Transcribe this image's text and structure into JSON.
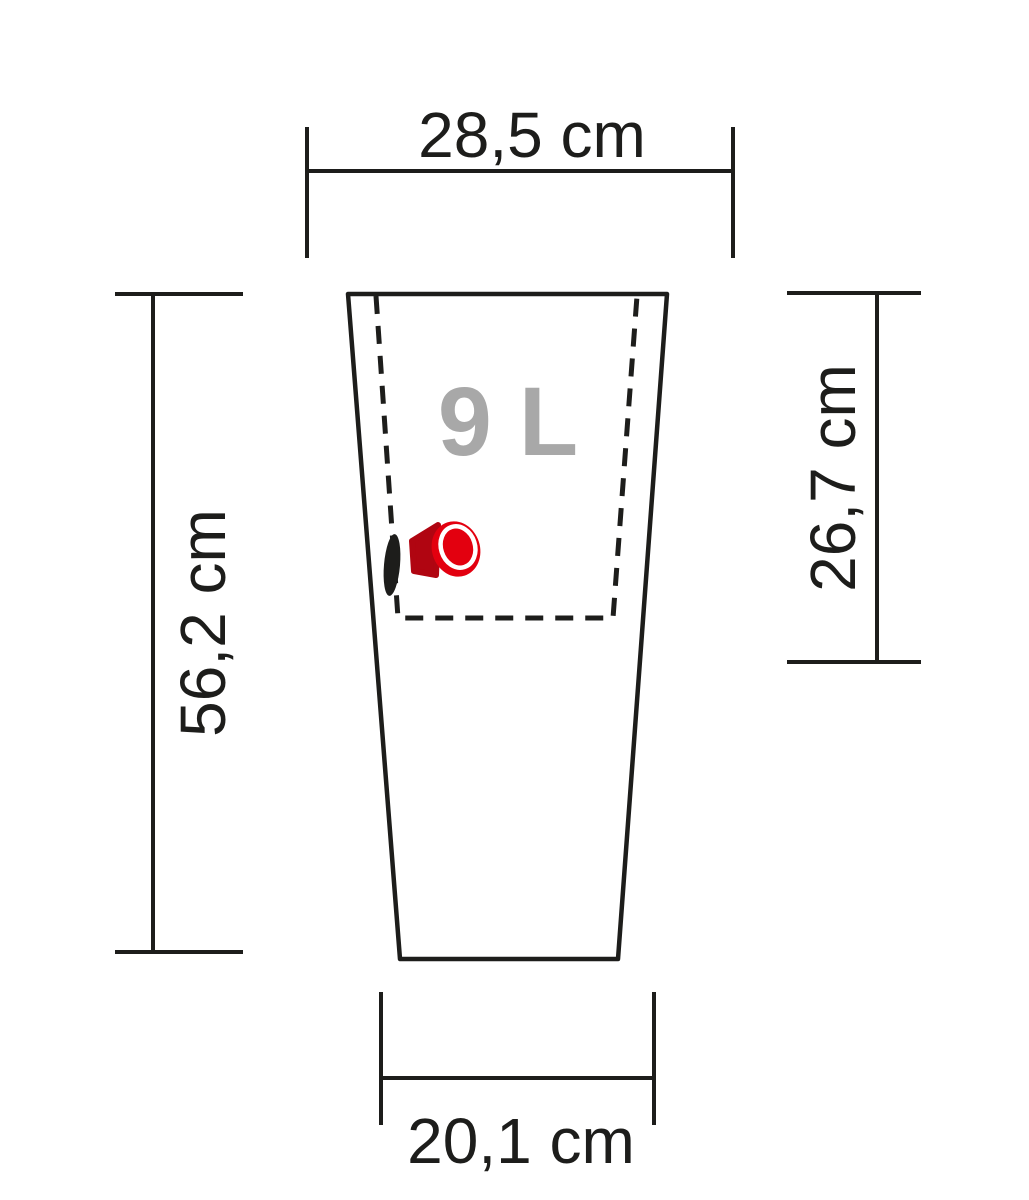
{
  "diagram": {
    "type": "technical-dimension-drawing",
    "subject": "tapered planter with inner liner and drain plug",
    "volume_label": "9 L",
    "dimensions": {
      "top_width": {
        "label": "28,5 cm",
        "value_cm": 28.5
      },
      "total_height": {
        "label": "56,2 cm",
        "value_cm": 56.2
      },
      "liner_height": {
        "label": "26,7 cm",
        "value_cm": 26.7
      },
      "bottom_width": {
        "label": "20,1 cm",
        "value_cm": 20.1
      }
    },
    "colors": {
      "line": "#1d1d1b",
      "text": "#1d1d1b",
      "volume_text": "#a8a8a8",
      "plug_red": "#e3000f",
      "plug_dark_red": "#b00511",
      "plug_highlight": "#ffffff",
      "background": "#ffffff"
    }
  }
}
